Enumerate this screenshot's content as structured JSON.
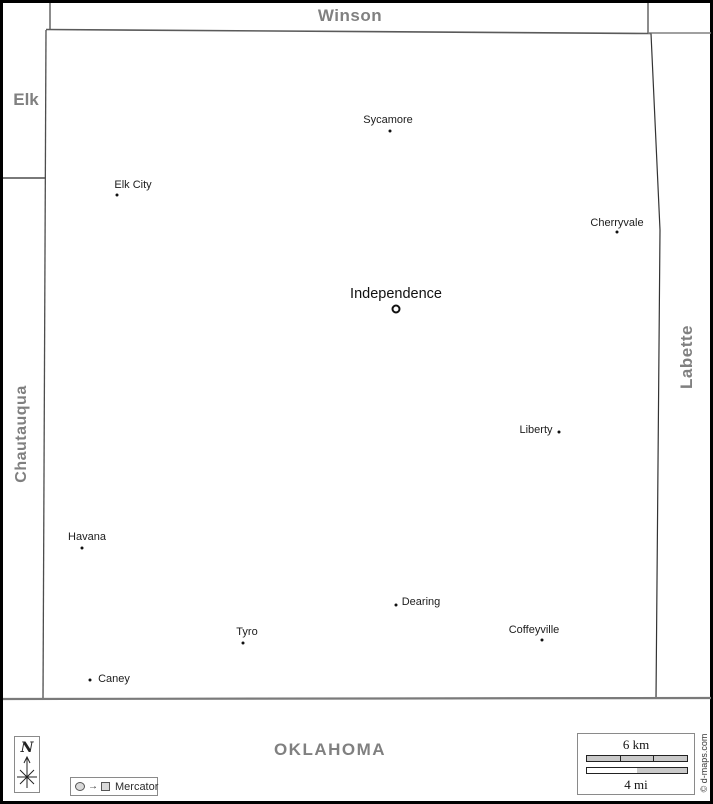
{
  "region": {
    "neighbors": {
      "top": "Winson",
      "top_left": "Elk",
      "left": "Chautauqua",
      "right": "Labette",
      "bottom": "OKLAHOMA"
    }
  },
  "cities": [
    {
      "name": "Sycamore",
      "label_x": 388,
      "label_y": 120,
      "dot_x": 390,
      "dot_y": 131,
      "marker": "dot"
    },
    {
      "name": "Elk City",
      "label_x": 133,
      "label_y": 185,
      "dot_x": 117,
      "dot_y": 195,
      "marker": "dot"
    },
    {
      "name": "Cherryvale",
      "label_x": 617,
      "label_y": 223,
      "dot_x": 617,
      "dot_y": 232,
      "marker": "dot"
    },
    {
      "name": "Independence",
      "label_x": 396,
      "label_y": 294,
      "dot_x": 396,
      "dot_y": 309,
      "marker": "ring",
      "county_seat": true
    },
    {
      "name": "Liberty",
      "label_x": 536,
      "label_y": 430,
      "dot_x": 559,
      "dot_y": 432,
      "marker": "dot"
    },
    {
      "name": "Havana",
      "label_x": 87,
      "label_y": 537,
      "dot_x": 82,
      "dot_y": 548,
      "marker": "dot"
    },
    {
      "name": "Dearing",
      "label_x": 421,
      "label_y": 602,
      "dot_x": 396,
      "dot_y": 605,
      "marker": "dot"
    },
    {
      "name": "Tyro",
      "label_x": 247,
      "label_y": 632,
      "dot_x": 243,
      "dot_y": 643,
      "marker": "dot"
    },
    {
      "name": "Coffeyville",
      "label_x": 534,
      "label_y": 630,
      "dot_x": 542,
      "dot_y": 640,
      "marker": "dot"
    },
    {
      "name": "Caney",
      "label_x": 114,
      "label_y": 679,
      "dot_x": 90,
      "dot_y": 680,
      "marker": "dot"
    }
  ],
  "compass": {
    "north_label": "N"
  },
  "legend": {
    "projection": "Mercator"
  },
  "scale_bar": {
    "km": "6 km",
    "mi": "4 mi"
  },
  "credit": "© d-maps.com",
  "colors": {
    "county_label": "#808080",
    "boundary": "#4d4d4d",
    "state_line": "#7a7a7a",
    "outer_border": "#000000",
    "city_text": "#1c1c1c"
  }
}
